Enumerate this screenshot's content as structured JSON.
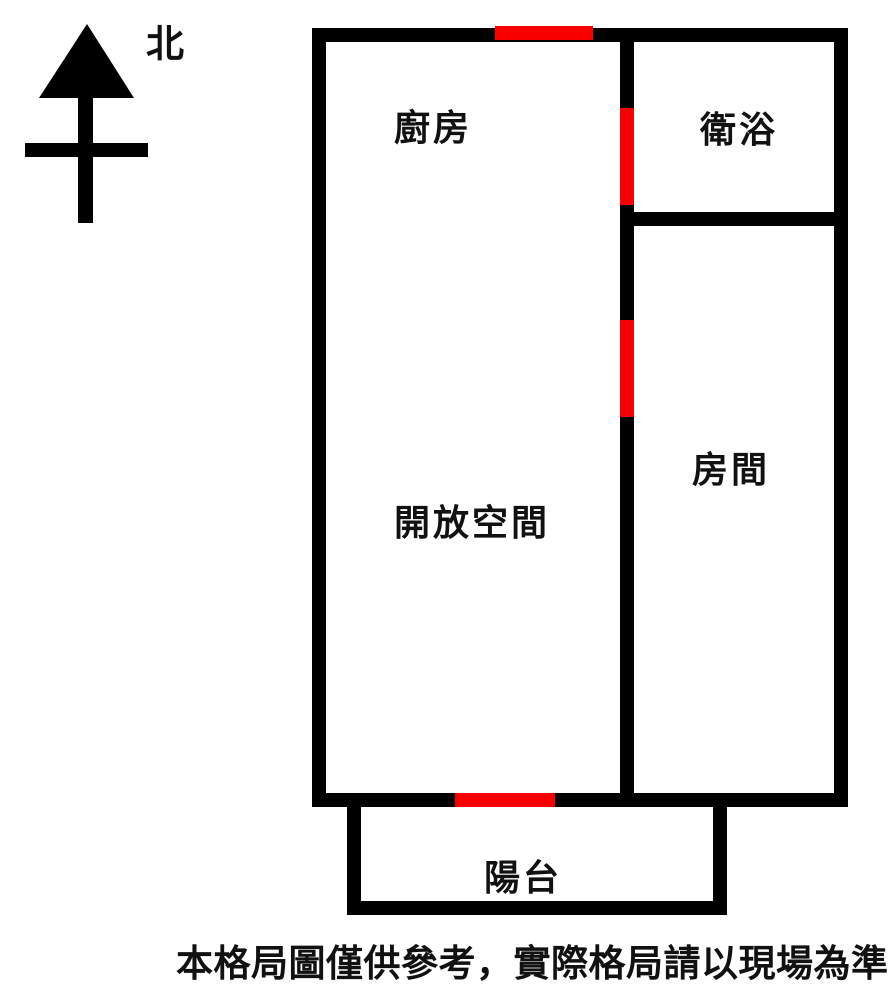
{
  "compass": {
    "label": "北"
  },
  "floor_plan": {
    "rooms": [
      {
        "id": "kitchen",
        "label": "廚房"
      },
      {
        "id": "bathroom",
        "label": "衛浴"
      },
      {
        "id": "bedroom",
        "label": "房間"
      },
      {
        "id": "open-space",
        "label": "開放空間"
      },
      {
        "id": "balcony",
        "label": "陽台"
      }
    ],
    "openings_count": 4,
    "colors": {
      "wall": "#000000",
      "opening_marker": "#f80000",
      "background": "#ffffff",
      "text": "#111111"
    }
  },
  "caption": "本格局圖僅供參考，實際格局請以現場為準"
}
